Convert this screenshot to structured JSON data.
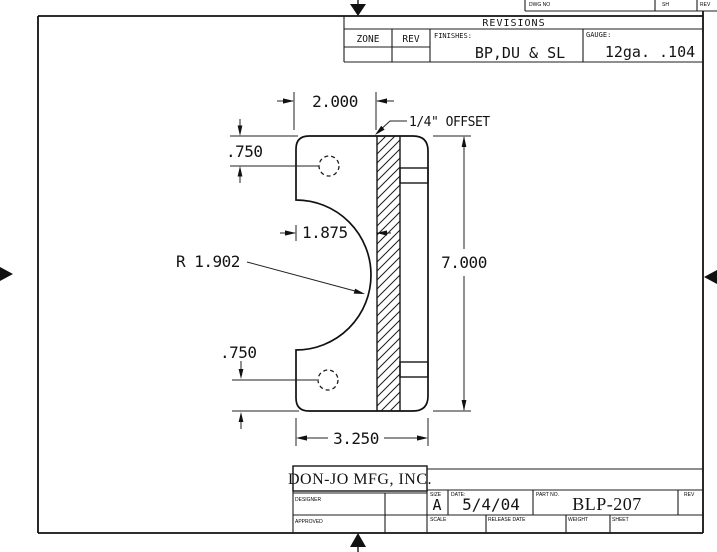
{
  "sheet_header": {
    "dwg_no_label": "DWG NO",
    "sh_label": "SH",
    "rev_label": "REV"
  },
  "revisions_table": {
    "title": "REVISIONS",
    "zone_label": "ZONE",
    "rev_label": "REV",
    "finishes_label": "FINISHES:",
    "finishes_value": "BP,DU & SL",
    "gauge_label": "GAUGE:",
    "gauge_value": "12ga. .104"
  },
  "drawing": {
    "dim_width_top": "2.000",
    "note_offset": "1/4\" OFFSET",
    "dim_hole_top": ".750",
    "dim_web": "1.875",
    "dim_radius": "R 1.902",
    "dim_height": "7.000",
    "dim_hole_bottom": ".750",
    "dim_width_overall": "3.250"
  },
  "title_block": {
    "company": "DON-JO MFG, INC.",
    "designer_label": "DESIGNER",
    "approved_label": "APPROVED",
    "size_label": "SIZE",
    "size_value": "A",
    "date_label": "DATE:",
    "date_value": "5/4/04",
    "part_no_label": "PART NO.",
    "part_no_value": "BLP-207",
    "rev_label": "REV",
    "scale_label": "SCALE",
    "release_date_label": "RELEASE DATE",
    "weight_label": "WEIGHT",
    "sheet_label": "SHEET"
  },
  "colors": {
    "line": "#1c1c1c",
    "background": "#ffffff"
  }
}
